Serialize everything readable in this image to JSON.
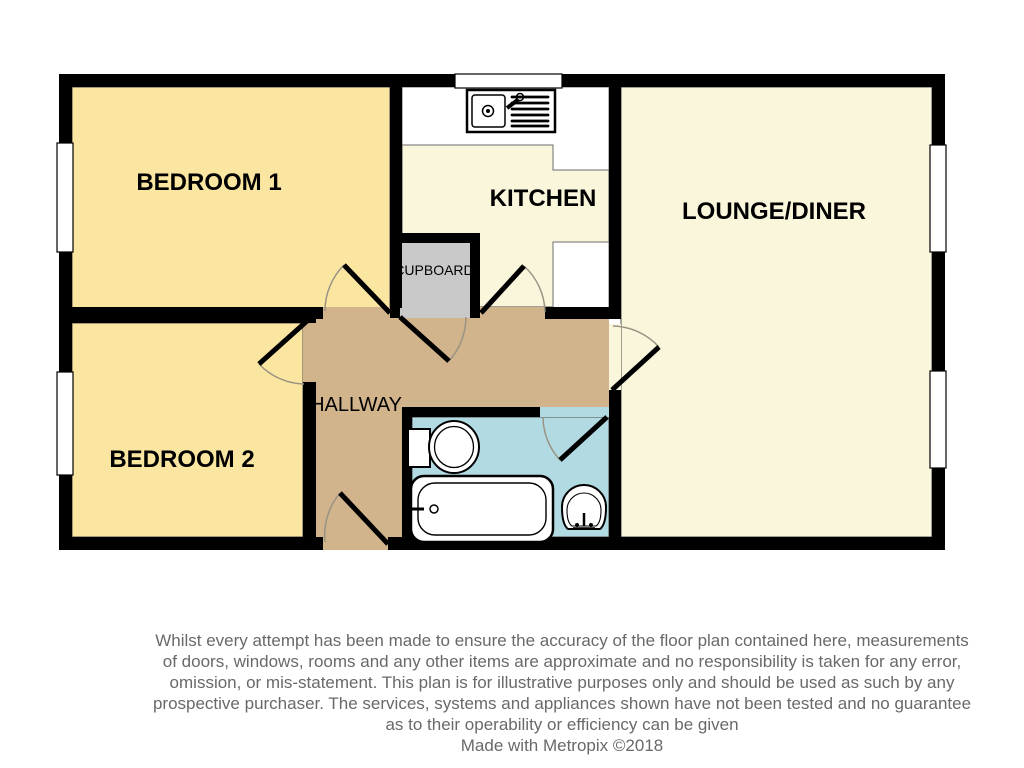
{
  "rooms": {
    "bedroom1": {
      "label": "BEDROOM 1"
    },
    "bedroom2": {
      "label": "BEDROOM 2"
    },
    "kitchen": {
      "label": "KITCHEN"
    },
    "lounge": {
      "label": "LOUNGE/DINER"
    },
    "cupboard": {
      "label": "CUPBOARD"
    },
    "hallway": {
      "label": "HALLWAY"
    }
  },
  "fixtures": {
    "kitchen_sink": "kitchen-sink-with-drainer",
    "toilet": "toilet",
    "bath": "bath-with-tap",
    "basin": "wash-basin"
  },
  "windows_count": "5",
  "doors_count": "7",
  "disclaimer": {
    "lines": [
      "Whilst every attempt has been made to ensure the accuracy of the floor plan contained here, measurements",
      "of doors, windows, rooms and any other items are approximate and no responsibility is taken for any error,",
      "omission, or mis-statement. This plan is for illustrative purposes only and should be used as such by any",
      "prospective purchaser. The services, systems and appliances shown have not been tested and no guarantee",
      "as to their operability or efficiency can be given"
    ],
    "credit": "Made with Metropix ©2018"
  },
  "colors": {
    "wall": "#000000",
    "bedroom_fill": "#FAE6A1",
    "living_fill": "#FAF6DC",
    "hallway_fill": "#D2B48C",
    "bathroom_fill": "#B2DAE3",
    "cupboard_fill": "#C9C9C9",
    "window_fill": "#FFFFFF",
    "counter_fill": "#FFFFFF",
    "counter_stroke": "#6E6E6E",
    "room_outline": "#4A4A4A",
    "door_arc": "#9A9384",
    "disclaimer_text": "#696969"
  }
}
